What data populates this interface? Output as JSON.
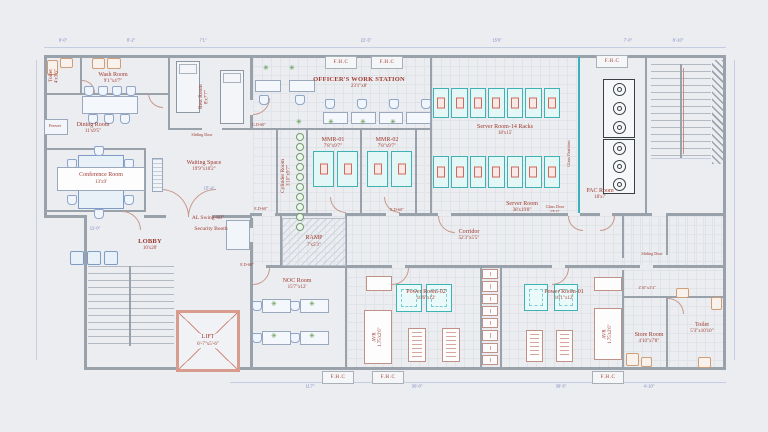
{
  "fhc_label": "F.H.C",
  "icons": {
    "plant": "✳"
  },
  "rooms": {
    "toilet_tl": {
      "name": "Toilet",
      "size": "4'x3'6\""
    },
    "wash": {
      "name": "Wash Room",
      "size": "9'1\"x4'7\""
    },
    "rest": {
      "name": "Rest Room",
      "size": "8'x7'7\""
    },
    "dining": {
      "name": "Dining Room",
      "size": "11'x9'5\""
    },
    "freezer": {
      "name": "Freezer"
    },
    "conference": {
      "name": "Conference Room",
      "size": "13'x9'"
    },
    "waiting": {
      "name": "Waiting Space",
      "size": "19'9\"x10'2\""
    },
    "lobby": {
      "name": "LOBBY",
      "size": "10'x20'"
    },
    "security_booth": {
      "name": "Security Booth"
    },
    "officer_ws": {
      "name": "OFFICER'S WORK STATION",
      "size": "23'1\"x8'"
    },
    "cylinder": {
      "name": "Cylinder Room",
      "size": "3'10\"x9'7\""
    },
    "mmr1": {
      "name": "MMR-01",
      "size": "7'8\"x9'7\""
    },
    "mmr2": {
      "name": "MMR-02",
      "size": "7'8\"x9'7\""
    },
    "server_racks": {
      "name": "Server Room-14 Racks",
      "size": "18'x15'"
    },
    "pac": {
      "name": "PAC Room",
      "size": "18'x7'"
    },
    "server": {
      "name": "Server Room",
      "size": "38'x19'8\""
    },
    "corridor": {
      "name": "Corridor",
      "size": "52'3\"x5'5\""
    },
    "ramp": {
      "name": "RAMP",
      "size": "7'x5'3\""
    },
    "noc": {
      "name": "NOC Room",
      "size": "15'7\"x12'"
    },
    "power2": {
      "name": "Power Room-02",
      "size": "16'6\"x12'"
    },
    "power1": {
      "name": "Power Room-01",
      "size": "16'1\"x12'"
    },
    "avr": {
      "name": "AVR",
      "size": "1.75'x2'6\""
    },
    "store": {
      "name": "Store Room",
      "size": "4'10\"x7'8\""
    },
    "toilet_br": {
      "name": "Toilet",
      "size": "5'3\"x10'10\""
    },
    "lift": {
      "name": "LIFT",
      "size": "6'-7\"x5'-6\""
    }
  },
  "annotations": {
    "up": "UP",
    "al_swing": "AL Swing-60\"",
    "sliding_door": "Sliding Door",
    "glass_partition": "Glass Partition",
    "glass_door_name": "Glass Door",
    "glass_door_size": "3'8\"x7'",
    "passage_size": "4'10\"x3'4\"",
    "door_tag_gd": "G.D-60\"",
    "door_tag_ed": "E.D-60\""
  },
  "dimensions": {
    "top": [
      "9'-0\"",
      "8'-2\"",
      "7'1\"",
      "22'-5\"",
      "15'6\"",
      "7'-0\"",
      "8'-10\""
    ],
    "bottom": [
      "11'7\"",
      "30'-0\"",
      "38'-5\"",
      "4'-10\""
    ],
    "inner": [
      "15'-4\"",
      "11'-0\""
    ]
  },
  "palette": {
    "wall": "#99a1ab",
    "label": "#9e392e",
    "dim": "#7d89c3",
    "teal": "#3fb3b3",
    "green": "#4e8c3e"
  }
}
